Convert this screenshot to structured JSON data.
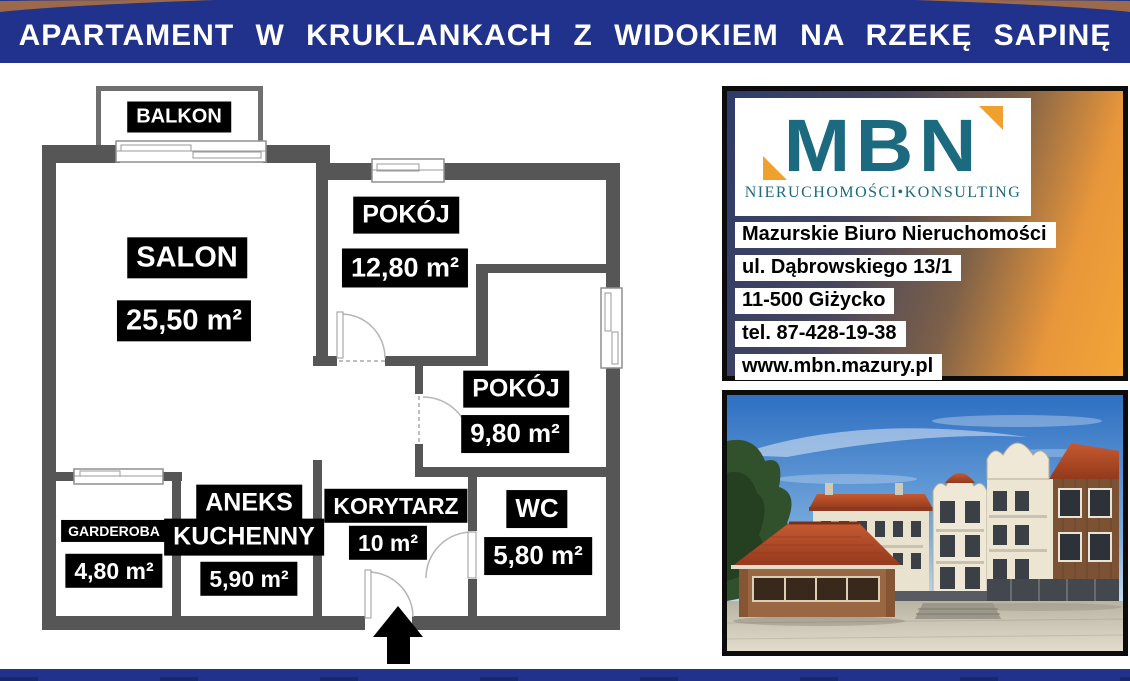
{
  "header": {
    "title": "APARTAMENT W KRUKLANKACH Z WIDOKIEM NA RZEKĘ SAPINĘ"
  },
  "floorplan": {
    "balkon": {
      "name": "BALKON"
    },
    "salon": {
      "name": "SALON",
      "area": "25,50 m²"
    },
    "pokoj_gorny": {
      "name": "POKÓJ",
      "area": "12,80 m²"
    },
    "pokoj_prawy": {
      "name": "POKÓJ",
      "area": "9,80 m²"
    },
    "garderoba": {
      "name": "GARDEROBA",
      "area": "4,80 m²"
    },
    "aneks": {
      "name_line1": "ANEKS",
      "name_line2": "KUCHENNY",
      "area": "5,90 m²"
    },
    "korytarz": {
      "name": "KORYTARZ",
      "area": "10 m²"
    },
    "wc": {
      "name": "WC",
      "area": "5,80 m²"
    }
  },
  "agency": {
    "logo_text": "MBN",
    "logo_subtitle": "NIERUCHOMOŚCI•KONSULTING",
    "name": "Mazurskie Biuro Nieruchomości",
    "street": "ul. Dąbrowskiego 13/1",
    "city": "11-500 Giżycko",
    "phone": "tel. 87-428-19-38",
    "website": "www.mbn.mazury.pl"
  },
  "colors": {
    "banner_navy": "#20328b",
    "wall_gray": "#565656",
    "label_bg": "#000000",
    "label_text": "#ffffff",
    "logo_teal": "#1b6a80",
    "logo_orange": "#f0a02c",
    "swoosh_brown": "#9c6a4a"
  }
}
